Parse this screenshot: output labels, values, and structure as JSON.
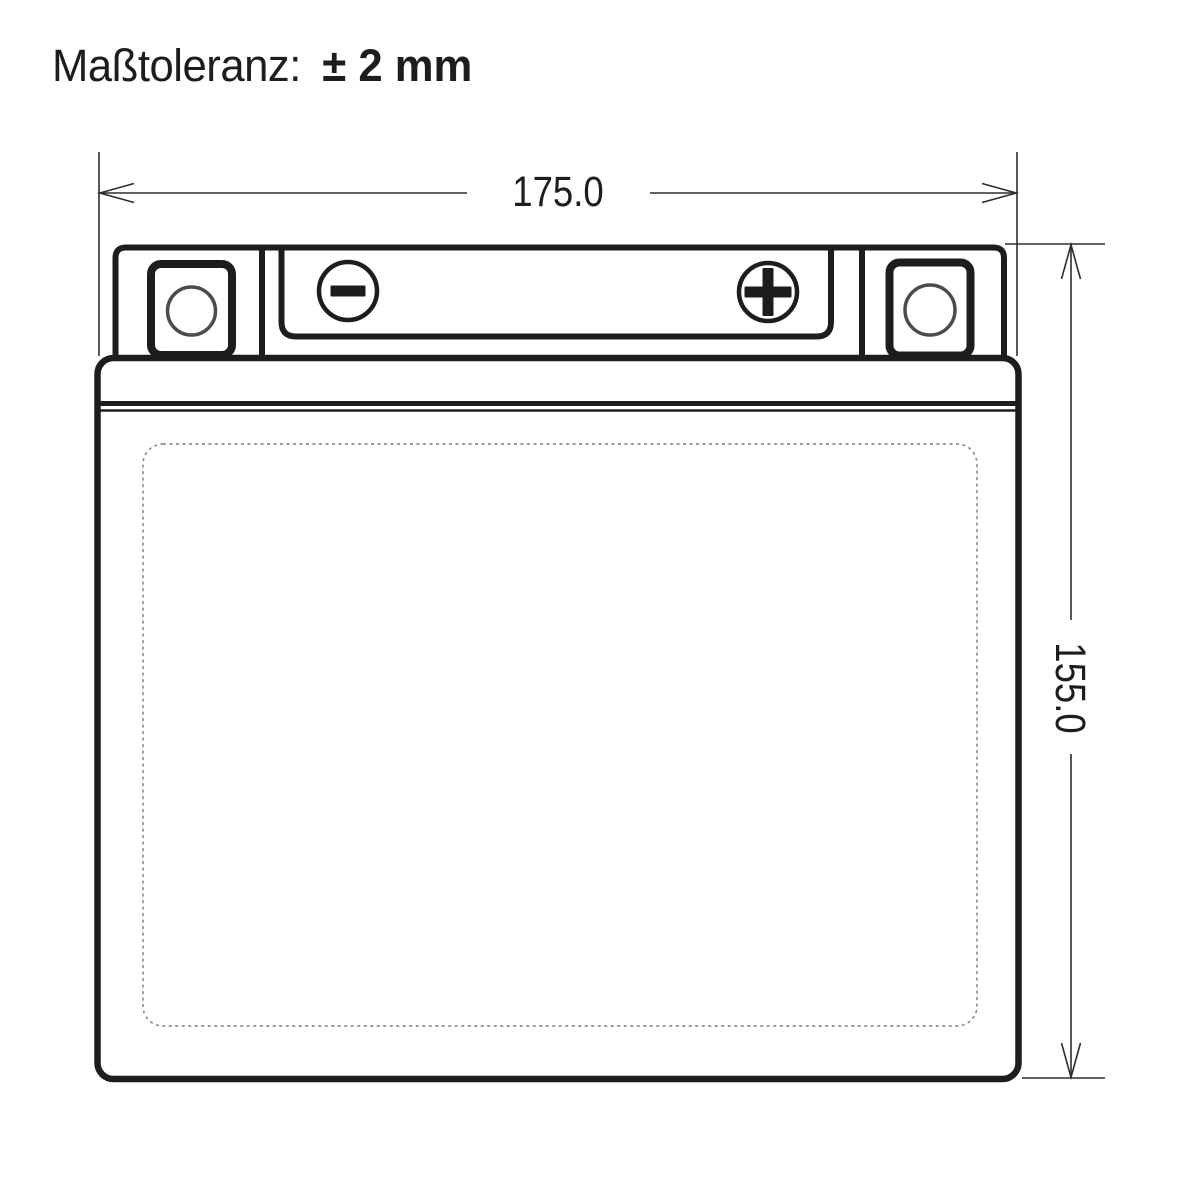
{
  "tolerance": {
    "label": "Maßtoleranz:",
    "value": "± 2 mm"
  },
  "dimensions": {
    "width_label": "175.0",
    "height_label": "155.0"
  },
  "drawing": {
    "subject": "battery-front-view",
    "terminals": {
      "negative_symbol": "−",
      "positive_symbol": "+"
    },
    "mounting_holes": 2
  },
  "colors": {
    "line": "#1d1d1b",
    "dim": "#2e2e2d",
    "dashed": "#8f8f8f",
    "background": "#ffffff"
  }
}
